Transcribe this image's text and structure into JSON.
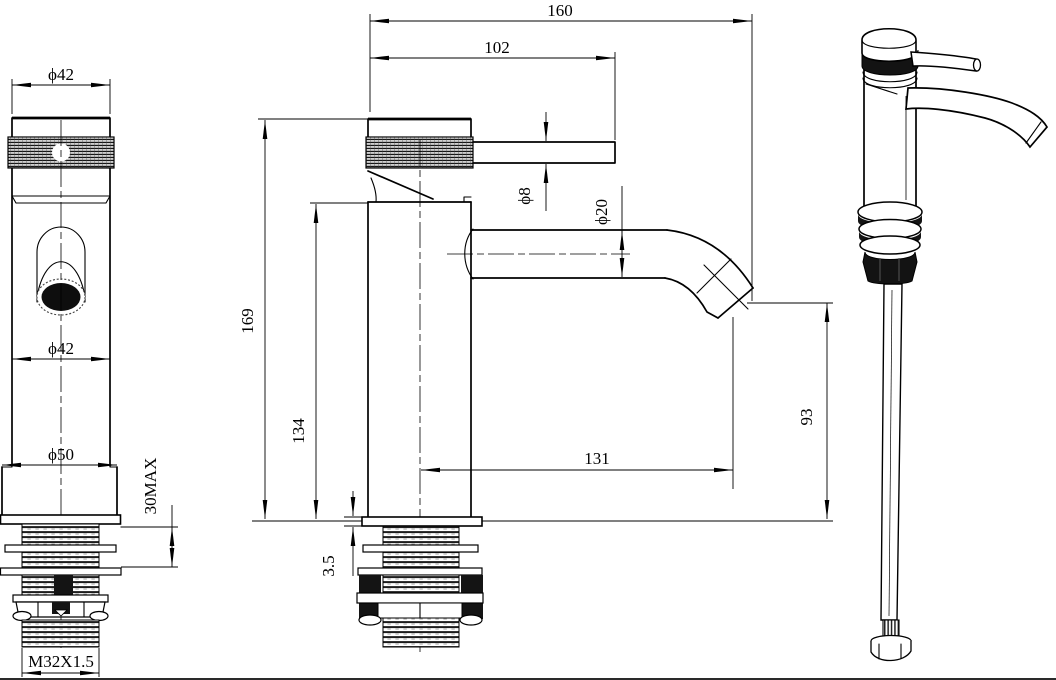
{
  "drawing": {
    "type": "technical-drawing-basin-faucet",
    "line_color": "#000000",
    "background": "#ffffff",
    "dims": {
      "front_cap_dia": "ϕ42",
      "front_spout_dia": "ϕ42",
      "front_base_dia": "ϕ50",
      "front_max_thickness": "30MAX",
      "front_thread": "M32X1.5",
      "side_total_reach": "160",
      "side_handle_reach": "102",
      "side_handle_dia": "ϕ8",
      "side_spout_dia": "ϕ20",
      "side_total_height": "169",
      "side_spout_height": "134",
      "side_plate_thickness": "3.5",
      "side_spout_reach": "131",
      "side_outlet_height": "93"
    }
  }
}
